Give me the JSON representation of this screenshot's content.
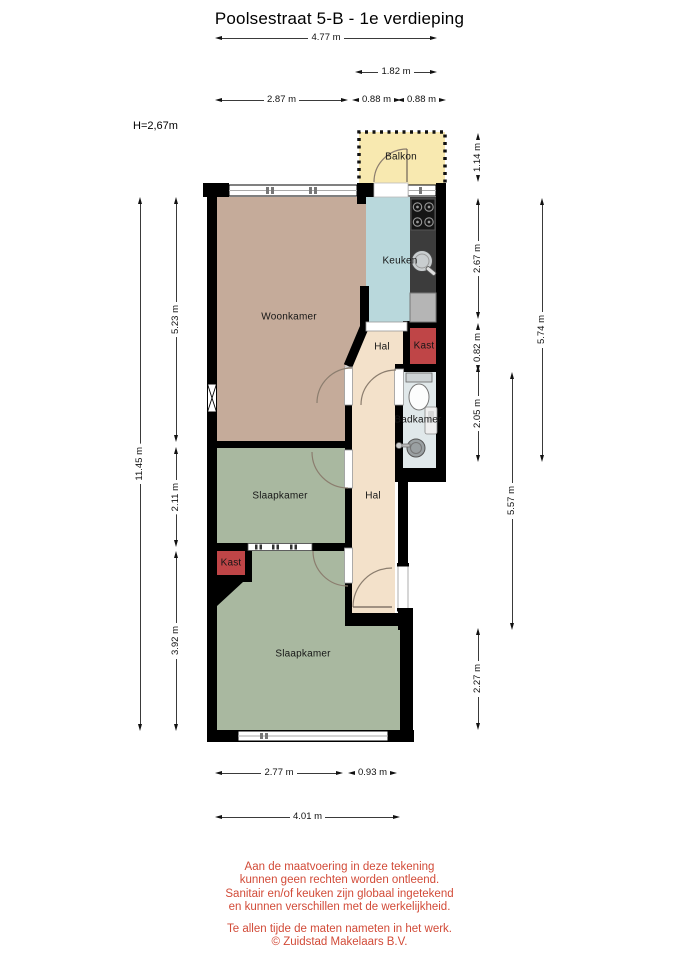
{
  "title": "Poolsestraat 5-B - 1e verdieping",
  "ceiling_height": "H=2,67m",
  "rooms": {
    "balkon": "Balkon",
    "keuken": "Keuken",
    "woonkamer": "Woonkamer",
    "hal_boven": "Hal",
    "kast_boven": "Kast",
    "badkamer": "Badkamer",
    "slaapkamer_midden": "Slaapkamer",
    "hal_onder": "Hal",
    "kast_onder": "Kast",
    "slaapkamer_onder": "Slaapkamer"
  },
  "dimensions": {
    "breedte_totaal": "4.77 m",
    "breedte_balkon": "1.82 m",
    "breedte_woonkamer": "2.87 m",
    "breedte_hal_keuken": "0.88 m",
    "breedte_keuken_rechts": "0.88 m",
    "hoogte_totaal": "11.45 m",
    "diepte_woonkamer": "5.23 m",
    "diepte_slaapkamer_midden": "2.11 m",
    "diepte_slaapkamer_onder": "3.92 m",
    "diepte_balkon": "1.14 m",
    "diepte_keuken": "2.67 m",
    "diepte_kast": "0.82 m",
    "diepte_badkamer": "2.05 m",
    "diepte_rechts_boven": "5.74 m",
    "diepte_hal": "5.57 m",
    "diepte_rechts_onder": "2.27 m",
    "breedte_slaapkamer_onder": "2.77 m",
    "breedte_hal_onder": "0.93 m",
    "breedte_onder_totaal": "4.01 m"
  },
  "disclaimer": [
    "Aan de maatvoering in deze tekening",
    "kunnen geen rechten worden ontleend.",
    "Sanitair en/of keuken zijn globaal ingetekend",
    "en kunnen verschillen met de werkelijkheid."
  ],
  "footer": [
    "Te allen tijde de maten nameten in het werk.",
    "© Zuidstad Makelaars B.V."
  ],
  "colors": {
    "muur": "#000000",
    "woonkamer": "#c5ab9a",
    "keuken": "#b9d8dc",
    "hal": "#f3e1ca",
    "kast": "#bf4547",
    "badkamer": "#e0e8ea",
    "slaapkamer": "#a9b8a0",
    "balkon": "#f8e9b0",
    "aanrecht": "#3c3c3c",
    "disclaimer_tekst": "#d24b38"
  }
}
